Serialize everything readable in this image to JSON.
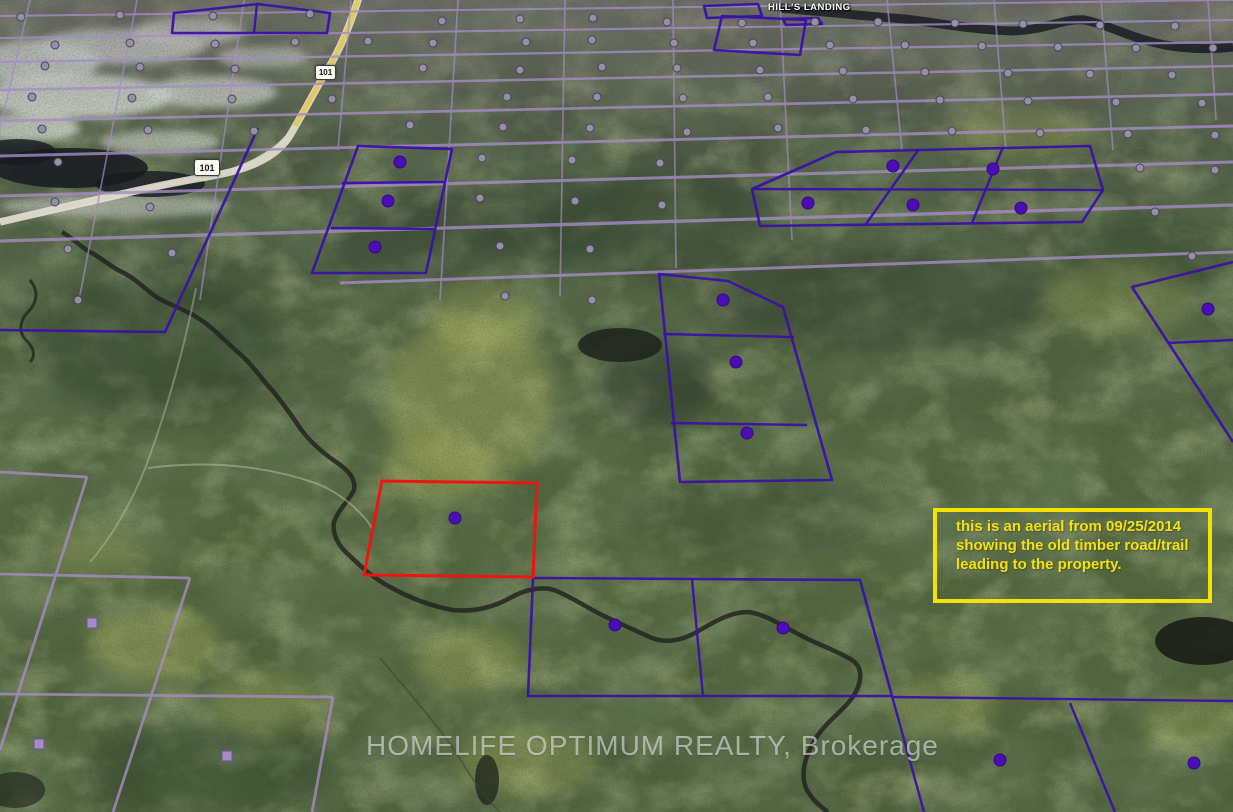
{
  "canvas": {
    "width": 1233,
    "height": 812
  },
  "map": {
    "place_label": "HILL'S LANDING",
    "highway_shield": "101",
    "watermark": "HOMELIFE OPTIMUM REALTY, Brokerage",
    "annotation": {
      "text": "this is an aerial from 09/25/2014 showing the old timber road/trail leading to the property.",
      "border_color": "#f2e400",
      "text_color": "#f0e312"
    },
    "overlay": {
      "grid_color": "#a48cc4",
      "parcel_color": "#3a12a8",
      "subject_color": "#ee1511",
      "marker_color": "#4a0db6",
      "dot_color": "#9691a2",
      "grid_rows": [
        [
          0,
          16,
          1233,
          0
        ],
        [
          0,
          38,
          1233,
          20
        ],
        [
          0,
          62,
          1233,
          42
        ],
        [
          0,
          90,
          1233,
          66
        ],
        [
          0,
          121,
          1233,
          94
        ],
        [
          0,
          156,
          1233,
          126
        ],
        [
          0,
          196,
          1233,
          162
        ],
        [
          0,
          241,
          1233,
          205
        ],
        [
          340,
          283,
          1233,
          252
        ]
      ],
      "grid_row_widths": [
        2,
        2.1,
        2.3,
        2.5,
        2.7,
        2.9,
        3.1,
        3.3,
        3
      ],
      "grid_cols": [
        [
          30,
          0,
          -40,
          300
        ],
        [
          137,
          0,
          80,
          295
        ],
        [
          244,
          0,
          200,
          300
        ],
        [
          351,
          0,
          338,
          150
        ],
        [
          458,
          0,
          440,
          300
        ],
        [
          565,
          0,
          560,
          296
        ],
        [
          673,
          0,
          676,
          268
        ],
        [
          780,
          0,
          792,
          240
        ],
        [
          887,
          0,
          902,
          150
        ],
        [
          994,
          0,
          1006,
          150
        ],
        [
          1101,
          0,
          1113,
          150
        ],
        [
          1208,
          0,
          1216,
          120
        ]
      ],
      "sparse_lines": [
        [
          0,
          472,
          87,
          477
        ],
        [
          87,
          477,
          0,
          750
        ],
        [
          0,
          574,
          190,
          578
        ],
        [
          190,
          578,
          113,
          812
        ],
        [
          0,
          694,
          333,
          697
        ],
        [
          333,
          697,
          312,
          812
        ]
      ],
      "parcels": [
        "174,13 258,4 330,13 327,33 172,33",
        "704,6 758,4 762,16 707,18",
        "783,19 818,18 822,24 786,25",
        "722,16 806,20 800,55 714,50",
        "358,146 452,149 426,273 312,273",
        "836,152 1090,146 1103,190 1082,222 760,226 752,189",
        "659,274 728,281 783,307 832,480 680,482",
        "533,578 860,580 892,696 528,696"
      ],
      "parcel_polylines": [
        "0,330 165,332 258,128",
        "1233,262 1132,287 1233,442"
      ],
      "parcel_lines": [
        [
          257,
          4,
          254,
          33
        ],
        [
          342,
          183,
          444,
          182
        ],
        [
          331,
          228,
          434,
          229
        ],
        [
          752,
          189,
          1103,
          190
        ],
        [
          919,
          149,
          866,
          224
        ],
        [
          1003,
          147,
          972,
          223
        ],
        [
          663,
          334,
          794,
          337
        ],
        [
          671,
          423,
          807,
          425
        ],
        [
          692,
          579,
          703,
          696
        ],
        [
          892,
          696,
          924,
          812
        ],
        [
          892,
          697,
          1233,
          701
        ],
        [
          1070,
          703,
          1115,
          812
        ],
        [
          1168,
          343,
          1233,
          340
        ]
      ],
      "subject_parcel": "382,481 537,483 533,577 364,575",
      "markers_dark": [
        [
          455,
          518
        ],
        [
          400,
          162
        ],
        [
          388,
          201
        ],
        [
          375,
          247
        ],
        [
          893,
          166
        ],
        [
          993,
          169
        ],
        [
          808,
          203
        ],
        [
          913,
          205
        ],
        [
          1021,
          208
        ],
        [
          723,
          300
        ],
        [
          736,
          362
        ],
        [
          747,
          433
        ],
        [
          1208,
          309
        ],
        [
          615,
          625
        ],
        [
          783,
          628
        ],
        [
          1000,
          760
        ],
        [
          1194,
          763
        ]
      ],
      "markers_square": [
        [
          92,
          623
        ],
        [
          39,
          744
        ],
        [
          227,
          756
        ]
      ],
      "dots": [
        [
          21,
          17
        ],
        [
          120,
          15
        ],
        [
          213,
          16
        ],
        [
          310,
          14
        ],
        [
          442,
          21
        ],
        [
          520,
          19
        ],
        [
          593,
          18
        ],
        [
          667,
          22
        ],
        [
          742,
          23
        ],
        [
          815,
          22
        ],
        [
          878,
          22
        ],
        [
          955,
          23
        ],
        [
          1023,
          24
        ],
        [
          1100,
          25
        ],
        [
          1175,
          26
        ],
        [
          55,
          45
        ],
        [
          130,
          43
        ],
        [
          215,
          44
        ],
        [
          295,
          42
        ],
        [
          368,
          41
        ],
        [
          433,
          43
        ],
        [
          526,
          42
        ],
        [
          592,
          40
        ],
        [
          674,
          43
        ],
        [
          753,
          43
        ],
        [
          830,
          45
        ],
        [
          905,
          45
        ],
        [
          982,
          46
        ],
        [
          1058,
          47
        ],
        [
          1136,
          48
        ],
        [
          1213,
          48
        ],
        [
          45,
          66
        ],
        [
          140,
          67
        ],
        [
          235,
          69
        ],
        [
          330,
          70
        ],
        [
          423,
          68
        ],
        [
          520,
          70
        ],
        [
          602,
          67
        ],
        [
          677,
          68
        ],
        [
          760,
          70
        ],
        [
          843,
          71
        ],
        [
          925,
          72
        ],
        [
          1008,
          73
        ],
        [
          1090,
          74
        ],
        [
          1172,
          75
        ],
        [
          32,
          97
        ],
        [
          132,
          98
        ],
        [
          232,
          99
        ],
        [
          332,
          99
        ],
        [
          507,
          97
        ],
        [
          597,
          97
        ],
        [
          683,
          98
        ],
        [
          768,
          97
        ],
        [
          853,
          99
        ],
        [
          940,
          100
        ],
        [
          1028,
          101
        ],
        [
          1116,
          102
        ],
        [
          1202,
          103
        ],
        [
          42,
          129
        ],
        [
          148,
          130
        ],
        [
          254,
          131
        ],
        [
          410,
          125
        ],
        [
          503,
          127
        ],
        [
          590,
          128
        ],
        [
          687,
          132
        ],
        [
          778,
          128
        ],
        [
          866,
          130
        ],
        [
          952,
          131
        ],
        [
          1040,
          133
        ],
        [
          1128,
          134
        ],
        [
          1215,
          135
        ],
        [
          58,
          162
        ],
        [
          482,
          158
        ],
        [
          572,
          160
        ],
        [
          660,
          163
        ],
        [
          1140,
          168
        ],
        [
          1215,
          170
        ],
        [
          55,
          202
        ],
        [
          150,
          207
        ],
        [
          480,
          198
        ],
        [
          575,
          201
        ],
        [
          662,
          205
        ],
        [
          1155,
          212
        ],
        [
          68,
          249
        ],
        [
          172,
          253
        ],
        [
          500,
          246
        ],
        [
          590,
          249
        ],
        [
          1192,
          256
        ],
        [
          78,
          300
        ],
        [
          505,
          296
        ],
        [
          592,
          300
        ]
      ]
    }
  }
}
